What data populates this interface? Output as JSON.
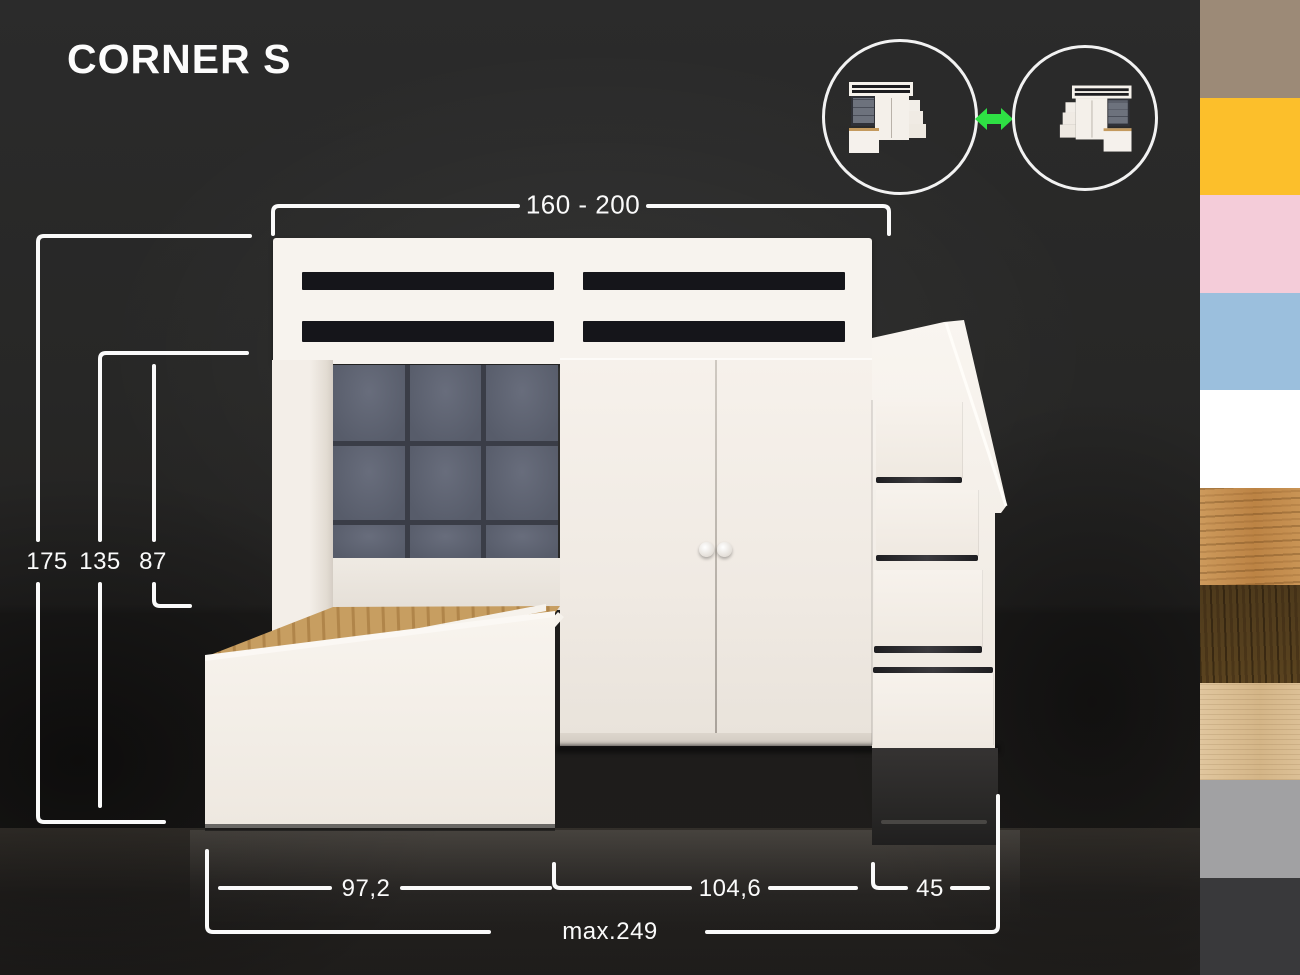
{
  "title": "CORNER S",
  "dimensions": {
    "top_width": "160 - 200",
    "height_total": "175",
    "height_mid": "135",
    "height_headboard": "87",
    "bed_depth": "97,2",
    "wardrobe_depth": "104,6",
    "stairs_depth": "45",
    "max_width": "max.249"
  },
  "variants": {
    "arrow_icon": "double-headed-swap-arrow",
    "arrow_color": "#2ee044"
  },
  "furniture": {
    "cushion_color": "#5d6273",
    "wood_deck_color": "#c49a5e",
    "body_color": "#f5f1eb"
  },
  "swatches": [
    {
      "name": "taupe",
      "color": "#9c8a77",
      "texture": "flat"
    },
    {
      "name": "yellow",
      "color": "#fcbf2b",
      "texture": "flat"
    },
    {
      "name": "pink",
      "color": "#f4ccd9",
      "texture": "flat"
    },
    {
      "name": "light-blue",
      "color": "#9bbfdd",
      "texture": "flat"
    },
    {
      "name": "white",
      "color": "#ffffff",
      "texture": "flat"
    },
    {
      "name": "oak-wood",
      "color": "#c08b4f",
      "texture": "wood-oak"
    },
    {
      "name": "walnut-wood",
      "color": "#58421f",
      "texture": "wood-walnut"
    },
    {
      "name": "light-wood",
      "color": "#d9bc92",
      "texture": "wood-light"
    },
    {
      "name": "gray",
      "color": "#a1a1a3",
      "texture": "flat"
    },
    {
      "name": "charcoal",
      "color": "#39393b",
      "texture": "flat"
    }
  ]
}
